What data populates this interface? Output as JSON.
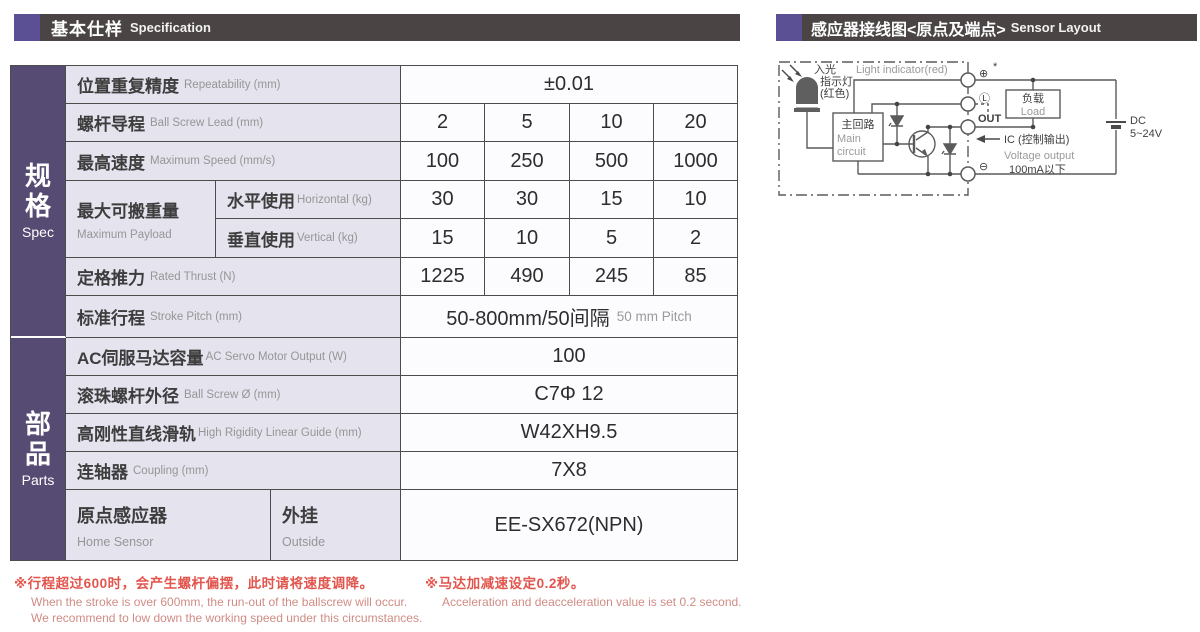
{
  "header_left": {
    "zh": "基本仕样",
    "en": "Specification"
  },
  "header_right": {
    "zh": "感应器接线图<原点及端点>",
    "en": "Sensor Layout"
  },
  "colors": {
    "accent_purple": "#5b5094",
    "sidebar_purple": "#564b72",
    "header_dark": "#4a4544",
    "label_bg": "#e4e3ee",
    "footnote_red": "#e2554d"
  },
  "spec_table": {
    "sidebar": {
      "spec_zh": "规格",
      "spec_en": "Spec",
      "parts_zh": "部品",
      "parts_en": "Parts"
    },
    "rows": [
      {
        "zh": "位置重复精度",
        "en": "Repeatability (mm)",
        "value": "±0.01"
      },
      {
        "zh": "螺杆导程",
        "en": "Ball Screw Lead (mm)",
        "values": [
          "2",
          "5",
          "10",
          "20"
        ]
      },
      {
        "zh": "最高速度",
        "en": "Maximum Speed (mm/s)",
        "values": [
          "100",
          "250",
          "500",
          "1000"
        ]
      },
      {
        "group_zh": "最大可搬重量",
        "group_en": "Maximum Payload",
        "zh": "水平使用",
        "en": "Horizontal (kg)",
        "values": [
          "30",
          "30",
          "15",
          "10"
        ]
      },
      {
        "zh": "垂直使用",
        "en": "Vertical (kg)",
        "values": [
          "15",
          "10",
          "5",
          "2"
        ]
      },
      {
        "zh": "定格推力",
        "en": "Rated Thrust (N)",
        "values": [
          "1225",
          "490",
          "245",
          "85"
        ]
      },
      {
        "zh": "标准行程",
        "en": "Stroke Pitch (mm)",
        "value": "50-800mm/50间隔",
        "value_en": "50 mm Pitch"
      },
      {
        "zh": "AC伺服马达容量",
        "en": "AC Servo Motor Output (W)",
        "value": "100"
      },
      {
        "zh": "滚珠螺杆外径",
        "en": "Ball Screw Ø (mm)",
        "value": "C7Φ 12"
      },
      {
        "zh": "高刚性直线滑轨",
        "en": "High Rigidity Linear Guide (mm)",
        "value": "W42XH9.5"
      },
      {
        "zh": "连轴器",
        "en": "Coupling (mm)",
        "value": "7X8"
      },
      {
        "zh": "原点感应器",
        "en": "Home Sensor",
        "sub_zh": "外挂",
        "sub_en": "Outside",
        "value": "EE-SX672(NPN)"
      }
    ]
  },
  "footnotes": [
    {
      "zh": "※行程超过600时，会产生螺杆偏摆，此时请将速度调降。",
      "en": [
        "When the stroke is over 600mm, the run-out of the ballscrew will occur.",
        "We recommend to low down the working speed under this circumstances."
      ]
    },
    {
      "zh": "※马达加减速设定0.2秒。",
      "en": [
        "Acceleration and deacceleration value is set 0.2 second."
      ]
    }
  ],
  "diagram": {
    "light_indicator_en": "Light indicator(red)",
    "light_zh1": "入光",
    "light_zh2": "指示灯",
    "light_zh3": "(红色)",
    "main_circuit_zh": "主回路",
    "main_circuit_en1": "Main",
    "main_circuit_en2": "circuit",
    "terminal_plus": "⊕",
    "terminal_star": "*",
    "terminal_l": "Ⓛ",
    "terminal_out": "OUT",
    "terminal_minus": "⊖",
    "load_zh": "负载",
    "load_en": "Load",
    "ic_label": "IC (控制输出)",
    "voltage_output": "Voltage output",
    "current_limit": "100mA以下",
    "dc1": "DC",
    "dc2": "5~24V"
  }
}
